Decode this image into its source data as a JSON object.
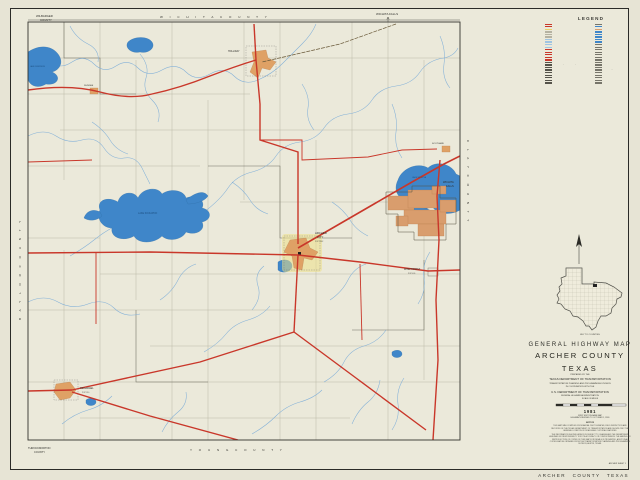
{
  "colors": {
    "highway_red": "#c9372a",
    "water_blue": "#3f86c9",
    "stream_blue": "#84b1d8",
    "town_orange": "#dfa165",
    "urban_tan": "#d99d6d",
    "halo_yellow": "#ece089",
    "paper": "#ebe9da"
  },
  "legend": {
    "title": "LEGEND",
    "left": [
      {
        "c": "#c9372a",
        "t": "INTERSTATE HIGHWAY"
      },
      {
        "c": "#c9372a",
        "t": "U.S. NUMBERED HIGHWAY"
      },
      {
        "c": "#e8d06a",
        "t": "STATE HIGHWAY"
      },
      {
        "c": "#b5b2a2",
        "t": "FARM OR RANCH TO MARKET ROAD"
      },
      {
        "c": "#b5b2a2",
        "t": "DIVIDED HIGHWAY"
      },
      {
        "c": "#b5b2a2",
        "t": "FREEWAY WITH FRONTAGE ROADS"
      },
      {
        "c": "#9fc4e2",
        "t": "PROPOSED HIGHWAY"
      },
      {
        "c": "#9fc4e2",
        "t": "GRADED AND DRAINED ROAD"
      },
      {
        "c": "#9fc4e2",
        "t": "SOIL SURFACED ROAD"
      },
      {
        "c": "#9fc4e2",
        "t": "LIGHT DUTY PAVED ROAD"
      },
      {
        "c": "#c9372a",
        "t": "INTERCHANGE"
      },
      {
        "c": "#c9372a",
        "t": "GRADE SEPARATION"
      },
      {
        "c": "#c9372a",
        "t": "U.S. HIGHWAY MARKER"
      },
      {
        "c": "#c9372a",
        "t": "STATE HIGHWAY MARKER"
      },
      {
        "c": "#c9372a",
        "t": "FARM ROAD MARKER"
      },
      {
        "c": "#55534a",
        "t": "RAILROAD"
      },
      {
        "c": "#55534a",
        "t": "RAILROAD (ABANDONED)"
      },
      {
        "c": "#55534a",
        "t": "AIRPORT OR LANDING FIELD"
      },
      {
        "c": "#55534a",
        "t": "PIPELINE"
      },
      {
        "c": "#55534a",
        "t": "POWER TRANSMISSION LINE"
      },
      {
        "c": "#55534a",
        "t": "COUNTY LINE"
      },
      {
        "c": "#55534a",
        "t": "CITY LIMIT LINE"
      },
      {
        "c": "#55534a",
        "t": "PRECINCT BOUNDARY"
      },
      {
        "c": "#55534a",
        "t": "SURVEY LINE"
      }
    ],
    "right": [
      {
        "c": "#77756a",
        "t": "COUNTY SEAT"
      },
      {
        "c": "#3f86c9",
        "t": "INCORPORATED CITY OR TOWN"
      },
      {
        "c": "#d99d6d",
        "t": "URBAN AREA"
      },
      {
        "c": "#3f86c9",
        "t": "STREAM OR CREEK"
      },
      {
        "c": "#3f86c9",
        "t": "LAKE OR RESERVOIR"
      },
      {
        "c": "#3f86c9",
        "t": "INTERMITTENT LAKE"
      },
      {
        "c": "#3f86c9",
        "t": "SPRING OR WELL"
      },
      {
        "c": "#3f86c9",
        "t": "DAM"
      },
      {
        "c": "#77756a",
        "t": "BRIDGE"
      },
      {
        "c": "#77756a",
        "t": "LOW WATER CROSSING"
      },
      {
        "c": "#77756a",
        "t": "SCHOOL"
      },
      {
        "c": "#77756a",
        "t": "CHURCH"
      },
      {
        "c": "#77756a",
        "t": "CEMETERY"
      },
      {
        "c": "#77756a",
        "t": "HOSPITAL"
      },
      {
        "c": "#77756a",
        "t": "REST AREA"
      },
      {
        "c": "#77756a",
        "t": "ROADSIDE PARK"
      },
      {
        "c": "#77756a",
        "t": "OIL OR GAS WELL"
      },
      {
        "c": "#77756a",
        "t": "OIL FIELD"
      },
      {
        "c": "#77756a",
        "t": "MINE OR QUARRY"
      },
      {
        "c": "#77756a",
        "t": "RADIO OR TV TOWER"
      },
      {
        "c": "#77756a",
        "t": "LOOKOUT TOWER"
      },
      {
        "c": "#77756a",
        "t": "RANCH OR FARM UNIT"
      },
      {
        "c": "#77756a",
        "t": "DWELLING"
      },
      {
        "c": "#77756a",
        "t": "OTHER BUILDING"
      }
    ]
  },
  "map": {
    "labels": {
      "wilbarger_1": "WILBARGER",
      "wilbarger_2": "COUNTY",
      "wichita_county": "W I C H I T A     C O U N T Y",
      "clay_county": "C L A Y     C O U N T Y",
      "baylor_county": "B A Y L O R     C O U N T Y",
      "young_county": "Y O U N G     C O U N T Y",
      "throckmorton_1": "THROCKMORTON",
      "throckmorton_2": "COUNTY",
      "wichita_falls_dir": "WICHITA FALLS",
      "holliday": "HOLLIDAY",
      "dundee": "DUNDEE",
      "archer_1": "ARCHER",
      "archer_2": "CITY",
      "archer_pop": "POP 1862",
      "megargel": "MEGARGEL",
      "megargel_pop": "POP 310",
      "windthorst": "WINDTHORST",
      "windthorst_pop": "POP 409",
      "scotland": "SCOTLAND",
      "wichita_falls_city_1": "WICHITA",
      "wichita_falls_city_2": "FALLS",
      "lake_kickapoo": "LAKE KICKAPOO",
      "lake_wichita": "LAKE WICHITA",
      "lake_diversion": "LAKE DIVERSION"
    }
  },
  "inset": {
    "caption": "KEY TO COUNTIES"
  },
  "title_block": {
    "line1": "GENERAL  HIGHWAY  MAP",
    "county": "ARCHER  COUNTY",
    "state": "TEXAS",
    "prepared_by": "PREPARED BY THE",
    "dept": "TEXAS  DEPARTMENT  OF  TRANSPORTATION",
    "division": "TRANSPORTATION PLANNING AND PROGRAMMING DIVISION",
    "coop": "IN COOPERATION WITH THE",
    "usdot": "U.S.  DEPARTMENT  OF  TRANSPORTATION",
    "fhwa": "FEDERAL  HIGHWAY  ADMINISTRATION"
  },
  "scale": {
    "label": "SCALE IN MILES"
  },
  "edition": {
    "year": "1981",
    "lines": [
      "FIRST EDITION BASE MAP",
      "HIGHWAYS REVISED TO OCTOBER 1, 1980"
    ]
  },
  "notice": {
    "heading": "NOTICE",
    "para1": "THIS MAP WAS COMPILED FROM AERIAL PHOTOGRAPHS, FIELD INSPECTION AND RECORDS OF THE TEXAS DEPARTMENT OF TRANSPORTATION AND SHOWS ONLY THE GENERAL LOCATION OF ROADS AND CULTURAL FEATURES.",
    "para2": "THE INFORMATION SHOWN HEREON IS SUBJECT TO CHANGE AND THE DEPARTMENT ASSUMES NO RESPONSIBILITY FOR ITS ACCURACY OR COMPLETENESS. THE MAKING OR REPRODUCTION OF COPIES OF THIS MAP FOR RESALE IS PROHIBITED. ADDITIONAL COPIES MAY BE OBTAINED FROM THE TRANSPORTATION PLANNING AND PROGRAMMING DIVISION, AUSTIN, TEXAS."
  },
  "sheet": {
    "sheet_label": "ARCHER  SHEET 1",
    "footer": "ARCHER  COUNTY   TEXAS"
  }
}
